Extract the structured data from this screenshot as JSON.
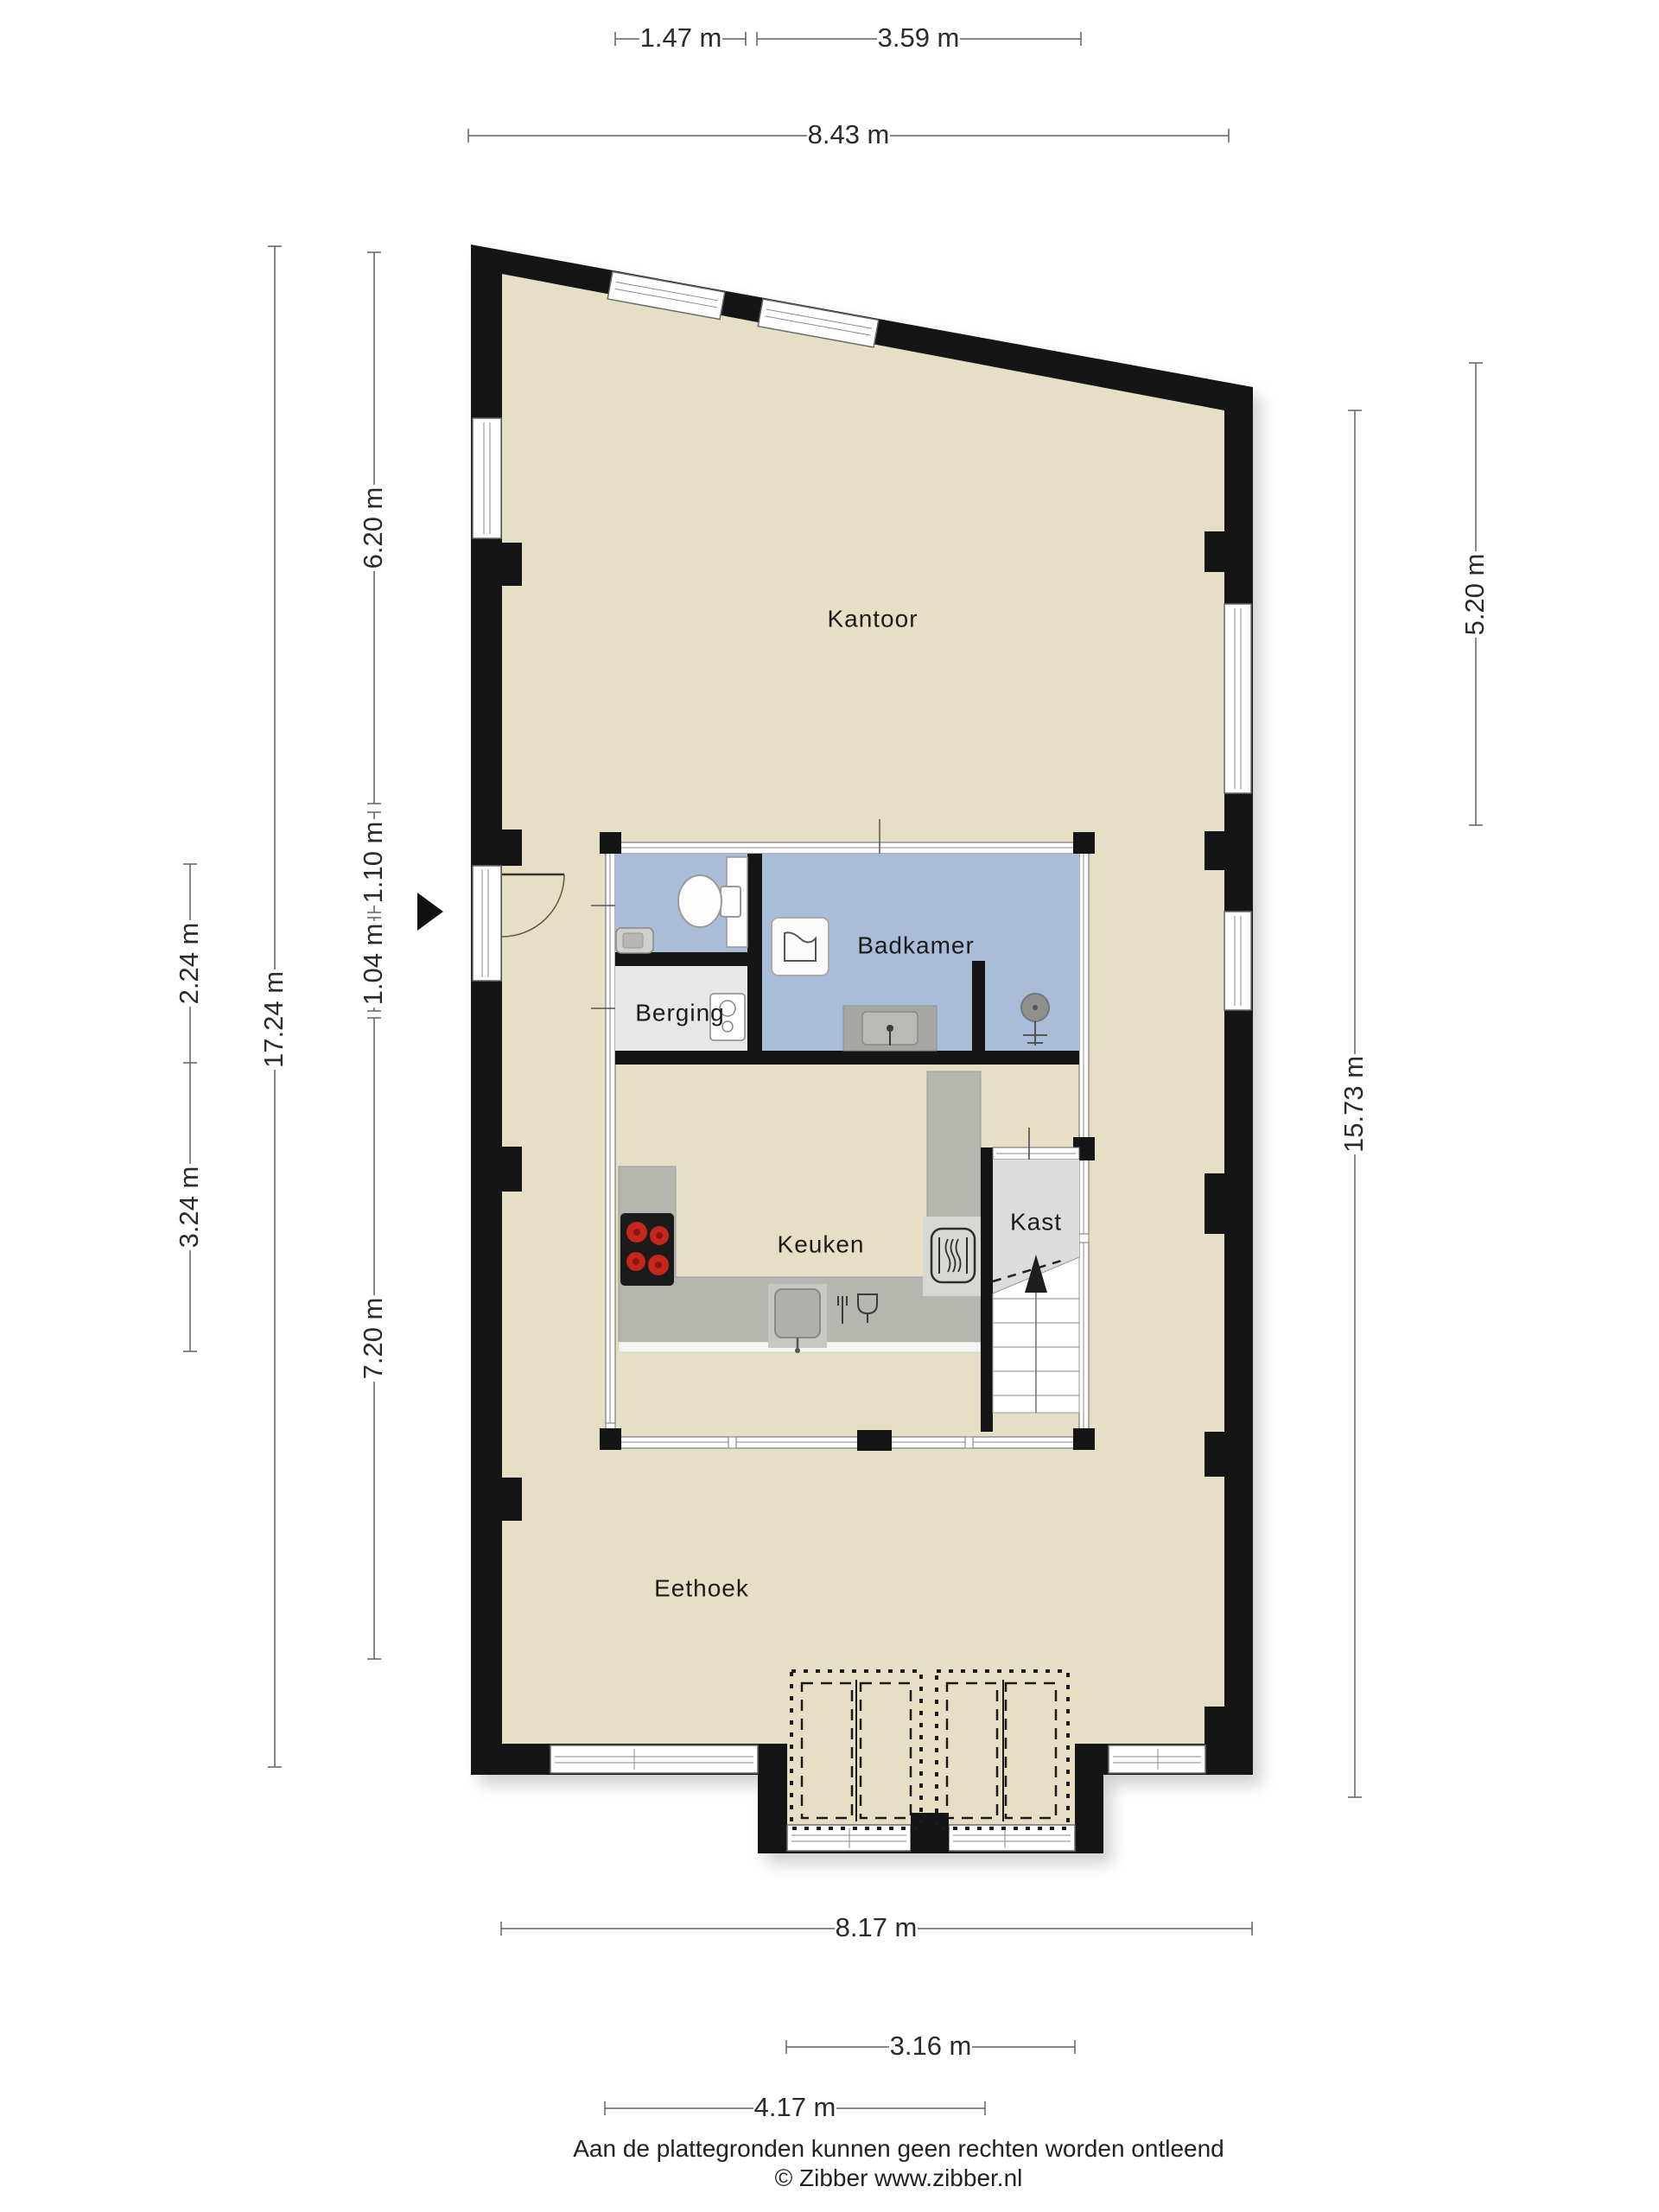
{
  "plan": {
    "rooms": [
      {
        "id": "kantoor",
        "label": "Kantoor"
      },
      {
        "id": "badkamer",
        "label": "Badkamer"
      },
      {
        "id": "berging",
        "label": "Berging"
      },
      {
        "id": "keuken",
        "label": "Keuken"
      },
      {
        "id": "kast",
        "label": "Kast"
      },
      {
        "id": "eethoek",
        "label": "Eethoek"
      }
    ],
    "dimensions": {
      "top": [
        {
          "id": "top-a",
          "label": "1.47 m"
        },
        {
          "id": "top-b",
          "label": "3.59 m"
        },
        {
          "id": "top-c",
          "label": "8.43 m"
        }
      ],
      "left": [
        {
          "id": "left-a",
          "label": "6.20 m"
        },
        {
          "id": "left-b",
          "label": "1.10 m"
        },
        {
          "id": "left-c",
          "label": "1.04 m"
        },
        {
          "id": "left-d",
          "label": "7.20 m"
        },
        {
          "id": "left-e",
          "label": "17.24 m"
        },
        {
          "id": "left-f",
          "label": "2.24 m"
        },
        {
          "id": "left-g",
          "label": "3.24 m"
        }
      ],
      "right": [
        {
          "id": "right-a",
          "label": "5.20 m"
        },
        {
          "id": "right-b",
          "label": "15.73 m"
        }
      ],
      "bottom": [
        {
          "id": "bottom-a",
          "label": "8.17 m"
        },
        {
          "id": "bottom-b",
          "label": "3.16 m"
        },
        {
          "id": "bottom-c",
          "label": "4.17 m"
        }
      ]
    },
    "icons": [
      "toilet-icon",
      "wc-sink-icon",
      "bath-icon",
      "vanity-sink-icon",
      "shower-icon",
      "boiler-icon",
      "cooktop-icon",
      "oven-icon",
      "kitchen-sink-icon",
      "dishwasher-icon",
      "stairs-up-arrow-icon",
      "entrance-arrow-icon"
    ],
    "footer": {
      "disclaimer": "Aan de plattegronden kunnen geen rechten worden ontleend",
      "credit": "© Zibber www.zibber.nl"
    },
    "colors": {
      "wall": "#151515",
      "floor": "#e7dfc5",
      "bathroom": "#a9bdd9",
      "storage": "#e7e7e7",
      "closet": "#dcdcdc",
      "counter": "#b6b6b1",
      "burner": "#c5271d"
    }
  }
}
